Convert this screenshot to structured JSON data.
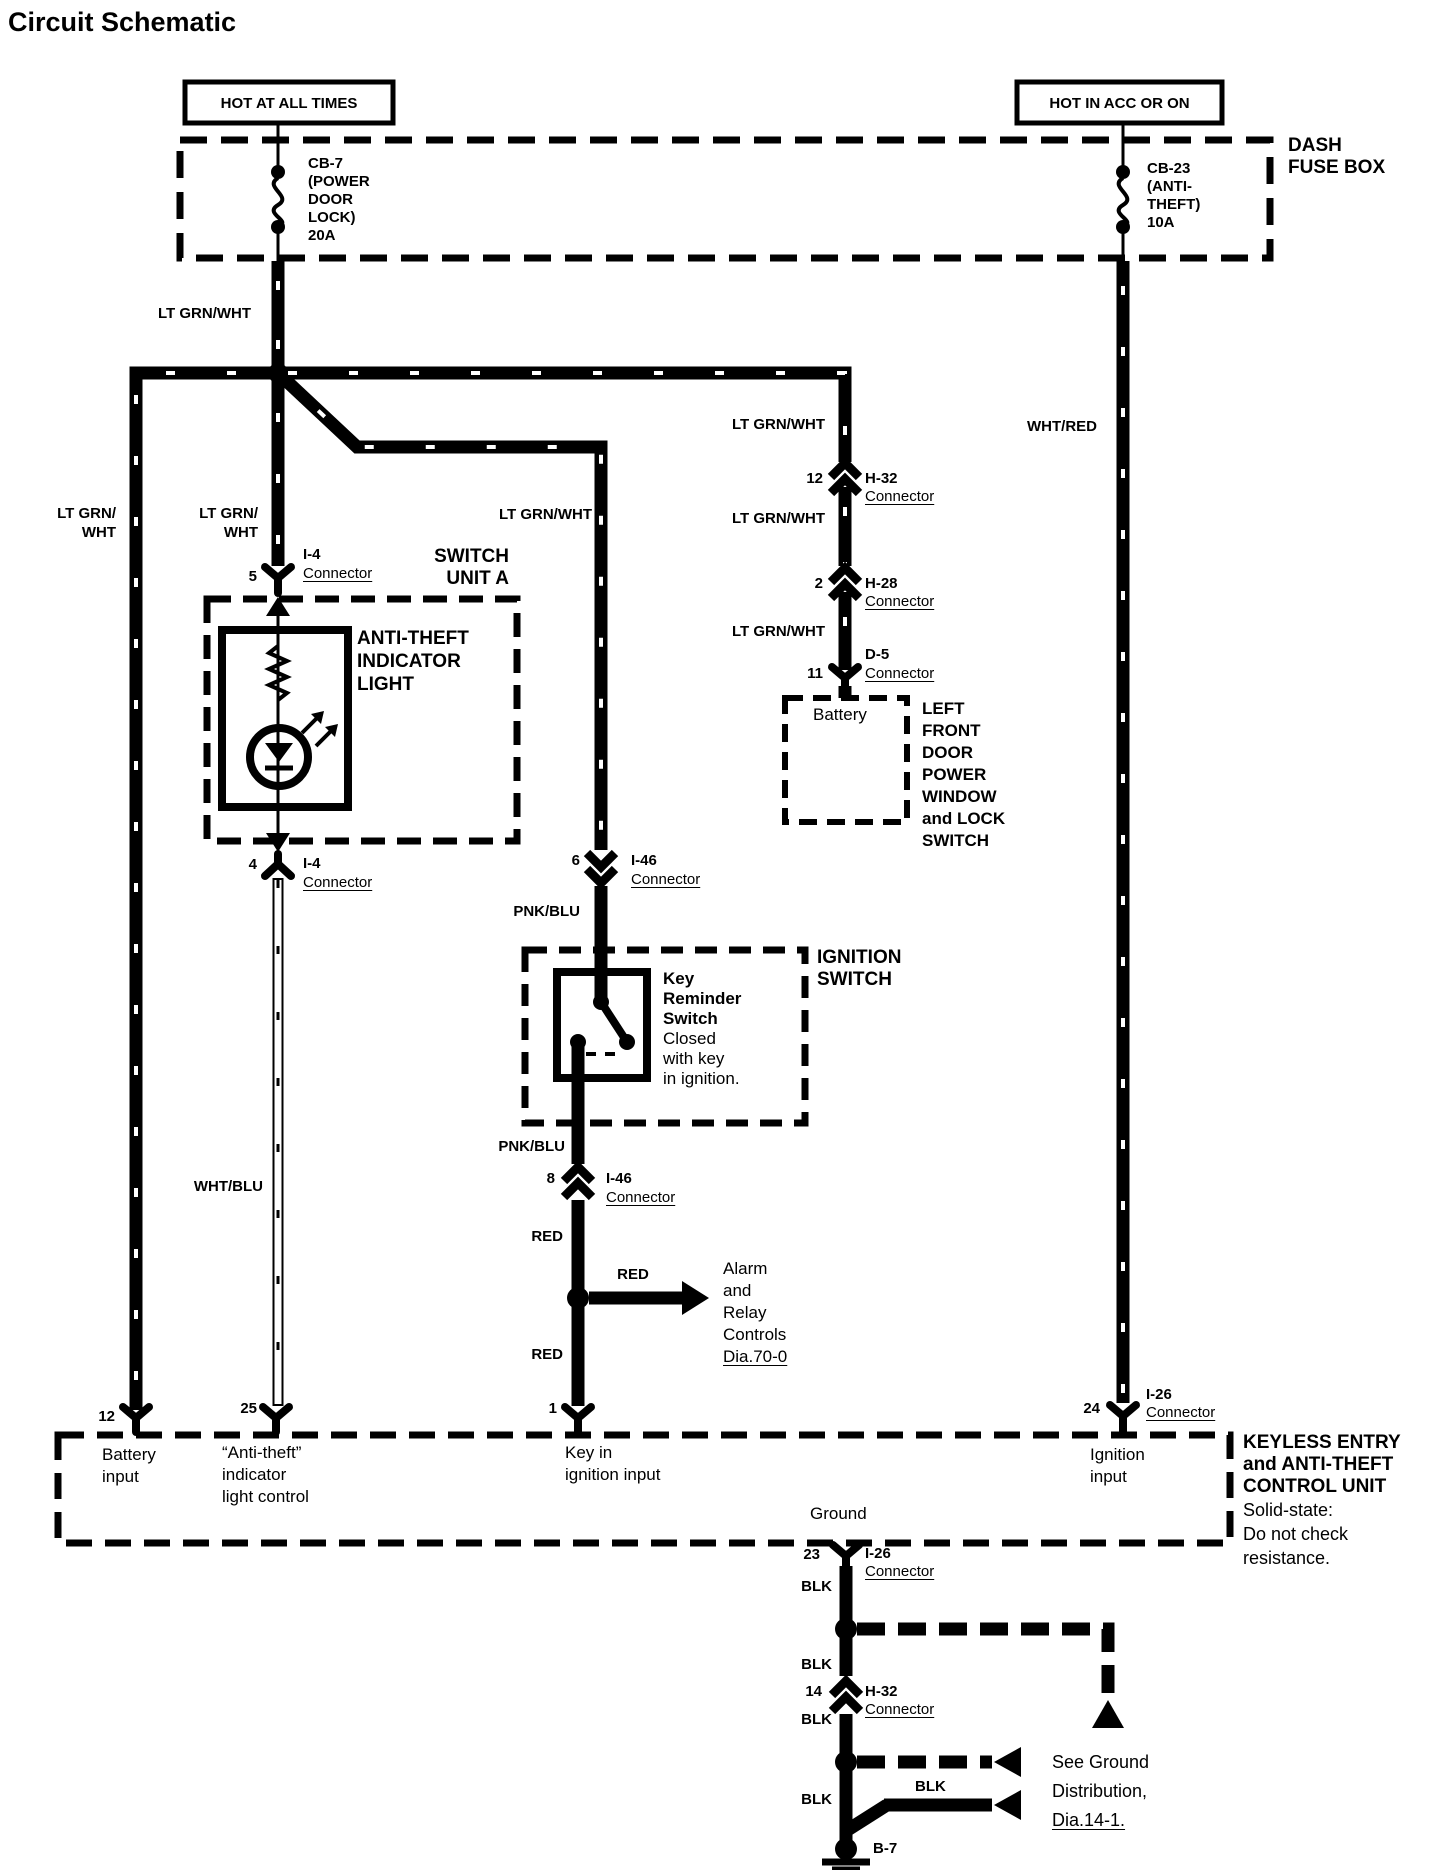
{
  "title": "Circuit Schematic",
  "banners": {
    "hot_all": "HOT AT ALL TIMES",
    "hot_acc": "HOT IN ACC OR ON"
  },
  "dash_fuse_box": {
    "label": [
      "DASH",
      "FUSE BOX"
    ],
    "cb7": [
      "CB-7",
      "(POWER",
      "DOOR",
      "LOCK)",
      "20A"
    ],
    "cb23": [
      "CB-23",
      "(ANTI-",
      "THEFT)",
      "10A"
    ]
  },
  "wires": {
    "lt_top": "LT GRN/WHT",
    "wht_red": "WHT/RED",
    "lt_left": [
      "LT GRN/",
      "WHT"
    ],
    "lt_mid": [
      "LT GRN/",
      "WHT"
    ],
    "lt_branch": "LT GRN/WHT",
    "lt_r1": "LT GRN/WHT",
    "lt_r2": "LT GRN/WHT",
    "lt_r3": "LT GRN/WHT",
    "wht_blu": "WHT/BLU",
    "pnk_blu_1": "PNK/BLU",
    "pnk_blu_2": "PNK/BLU",
    "red_1": "RED",
    "red_arrow": "RED",
    "red_2": "RED",
    "blk_1": "BLK",
    "blk_2": "BLK",
    "blk_3": "BLK",
    "blk_4": "BLK",
    "blk_5": "BLK"
  },
  "connectors": {
    "i4_top": {
      "pin": "5",
      "name": "I-4",
      "word": "Connector"
    },
    "i4_bot": {
      "pin": "4",
      "name": "I-4",
      "word": "Connector"
    },
    "h32": {
      "pin": "12",
      "name": "H-32",
      "word": "Connector"
    },
    "h28": {
      "pin": "2",
      "name": "H-28",
      "word": "Connector"
    },
    "d5": {
      "pin": "11",
      "name": "D-5",
      "word": "Connector"
    },
    "i46_top": {
      "pin": "6",
      "name": "I-46",
      "word": "Connector"
    },
    "i46_bot": {
      "pin": "8",
      "name": "I-46",
      "word": "Connector"
    },
    "i26_top": {
      "pin": "24",
      "name": "I-26",
      "word": "Connector"
    },
    "i26_bot": {
      "pin": "23",
      "name": "I-26",
      "word": "Connector"
    },
    "h32_b": {
      "pin": "14",
      "name": "H-32",
      "word": "Connector"
    }
  },
  "components": {
    "switch_unit_a": [
      "SWITCH",
      "UNIT A"
    ],
    "anti_theft_light": [
      "ANTI-THEFT",
      "INDICATOR",
      "LIGHT"
    ],
    "battery": "Battery",
    "left_front_door": [
      "LEFT",
      "FRONT",
      "DOOR",
      "POWER",
      "WINDOW",
      "and LOCK",
      "SWITCH"
    ],
    "ignition_switch": [
      "IGNITION",
      "SWITCH"
    ],
    "key_reminder_bold": [
      "Key",
      "Reminder",
      "Switch"
    ],
    "key_reminder_note": [
      "Closed",
      "with key",
      "in ignition."
    ],
    "keyless_bold": [
      "KEYLESS ENTRY",
      "and ANTI-THEFT",
      "CONTROL UNIT"
    ],
    "keyless_note": [
      "Solid-state:",
      "Do not check",
      "resistance."
    ],
    "alarm_lines": [
      "Alarm",
      "and",
      "Relay",
      "Controls"
    ],
    "alarm_ref": "Dia.70-0",
    "see_ground_lines": [
      "See Ground",
      "Distribution,"
    ],
    "see_ground_ref": "Dia.14-1.",
    "ground_point": "B-7"
  },
  "control_unit": {
    "p12": "12",
    "p25": "25",
    "p1": "1",
    "p24": "24",
    "battery_input": [
      "Battery",
      "input"
    ],
    "anti_theft_ctrl": [
      "“Anti-theft”",
      "indicator",
      "light control"
    ],
    "key_in": [
      "Key in",
      "ignition input"
    ],
    "ignition_input": [
      "Ignition",
      "input"
    ],
    "ground": "Ground"
  },
  "colors": {
    "ink": "#000000",
    "paper": "#ffffff"
  }
}
